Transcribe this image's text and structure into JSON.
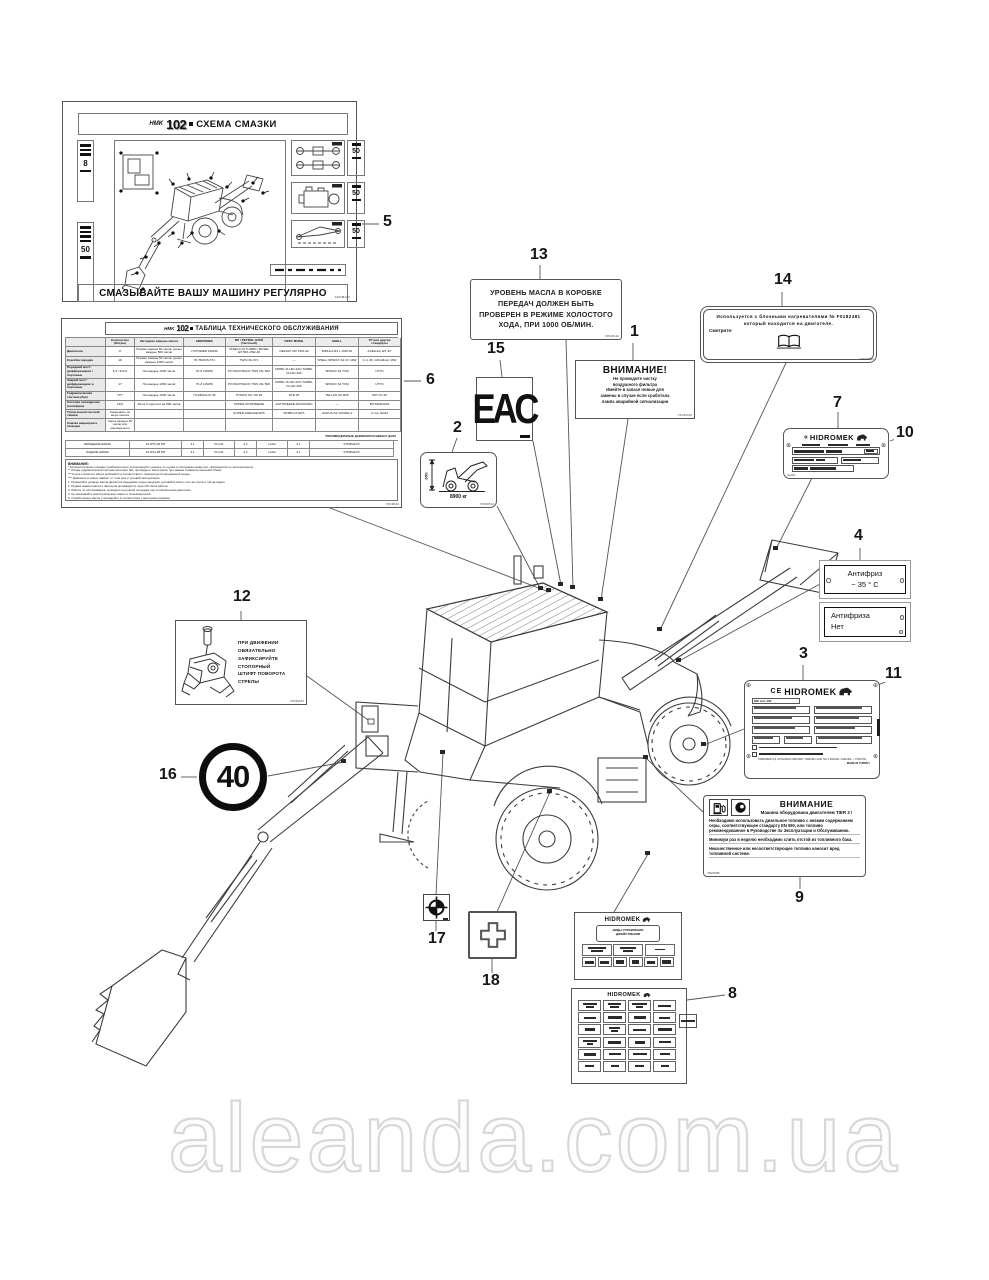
{
  "watermark": "aleanda.com.ua",
  "callouts": {
    "n1": "1",
    "n2": "2",
    "n3": "3",
    "n4": "4",
    "n5": "5",
    "n6": "6",
    "n7": "7",
    "n8": "8",
    "n9": "9",
    "n10": "10",
    "n11": "11",
    "n12": "12",
    "n13": "13",
    "n14": "14",
    "n15": "15",
    "n16": "16",
    "n17": "17",
    "n18": "18"
  },
  "lube": {
    "brand": "HMK",
    "model": "102",
    "title": "СХЕМА СМАЗКИ",
    "left_top": "8",
    "left_bottom": "50",
    "r1": "50",
    "r2": "50",
    "r3": "50",
    "bottom": "СМАЗЫВАЙТЕ ВАШУ МАШИНУ РЕГУЛЯРНО",
    "code": "A02/M102"
  },
  "maint": {
    "brand": "HMK",
    "model": "102",
    "title": "ТАБЛИЦА ТЕХНИЧЕСКОГО ОБСЛУЖИВАНИЯ",
    "grid": [
      [
        "",
        "Количество (Литры)",
        "Интервал замены масла",
        "HIDROMEK",
        "BP / PETROL OFİSİ (Частный)",
        "OPET MOBIL",
        "SHELL",
        "ТР или другие стандарты"
      ],
      [
        "Двигатель",
        "8",
        "Первая замена 50 часов, далее каждые 500 часов",
        "HI POWER 10W40",
        "VANELLUS TURBO / BCSEL EXTRA 15W-40",
        "DELVAC MX 15W-40",
        "RIMULA R4 L 15W-40",
        "ACEA E3, E5, E7"
      ],
      [
        "Коробка передач",
        "16",
        "Первая замена 50 часов, далее каждые 1000 часов",
        "HI-TRANS 671",
        "TWS OIL 671",
        "—",
        "SHELL SPIRAX S4 CX 10W",
        "C-4, ZF, GM Allison 10W"
      ],
      [
        "Передний мост: дифференциал / бортовые",
        "6,3 / 2x0,6",
        "На каждые 1000 часов",
        "HI-Z 10W30",
        "PO MAXTRACK TWS OIL 500",
        "MOBIL FLUID 424 / MOBIL FLUID 426",
        "SPIRAX S4 TXM",
        "UTTO"
      ],
      [
        "Задний мост: дифференциал и бортовые",
        "17",
        "На каждые 1000 часов",
        "HI-Z 10W30",
        "PO MAXTRACK TWS OIL 500",
        "MOBIL FLUID 424 / MOBIL FLUID 426",
        "SPIRAX S4 TXM",
        "UTTO"
      ],
      [
        "Гидравлическая система (бак)",
        "70**",
        "На каждые 1000 часов",
        "HI-DRAULIC 46",
        "HYDRO OIL XD 46",
        "DTE 25",
        "TELLUS S2 M46",
        "ISO VG 46"
      ],
      [
        "Система охлаждения (антифриз)",
        "18,5",
        "Раз в 2 года или на 500 часов",
        "",
        "SUPER ANTIFREEZE",
        "ANTIFREEZE ADVANCED",
        "—",
        "BS 6580/1992"
      ],
      [
        "Точки консистентной смазки",
        "Смазывать по мере износа",
        "",
        "",
        "SUPER GREASE EPS",
        "MOBILUX EPS",
        "GADUS S2 V220AD 2",
        "Li-Ca, MoS2"
      ],
      [
        "Смазка шарниров и пальцев",
        "Через каждые 50 часов или еженедельно",
        "",
        "",
        "",
        "",
        "",
        ""
      ]
    ],
    "tires_title": "РЕКОМЕНДУЕМЫЕ ДАВЛЕНИЯ В ШИНАХ (БАР)",
    "tires": [
      [
        "ПЕРЕДНИЕ ШИНЫ",
        "16.9/70-30 PR",
        "3.1",
        "PCL41",
        "4.4",
        "LASA",
        "3.1",
        "STARMAXX"
      ],
      [
        "ЗАДНИЕ ШИНЫ",
        "16.9/14-28 PR",
        "3.1",
        "PCL41",
        "4.4",
        "LASA",
        "3.1",
        "STARMAXX"
      ]
    ],
    "notes_title": "ВНИМАНИЕ:",
    "notes_starred": [
      "* Количество масел указано приблизительно; контролируйте уровень по щупам и смотровым окнам (см. «Руководство по эксплуатации»).",
      "** Объём гидравлической системы включает бак, цилиндры и магистрали; при замене сливается меньший объём.",
      "*** Сорта и вязкость масел выбирайте в соответствии с температурой окружающей среды.",
      "**** Давление в шинах зависит от типа шин и условий эксплуатации."
    ],
    "notes_numbered": [
      "1. Проверяйте уровень масла двигателя ежедневно перед запуском; доливайте масло того же сорта и той же марки.",
      "2. Первая замена масла и фильтров производится через 50 часов работы.",
      "3. Работы по обслуживанию проводите на ровной площадке при остановленном двигателе.",
      "4. Не смешивайте масла различных марок и производителей.",
      "5. Отработанные масла утилизируйте в соответствии с местными нормами.",
      "6. Консистентную смазку наносите до появления свежей смазки из зазоров."
    ],
    "code": "Y06/M102"
  },
  "gearbox": {
    "lines": [
      "УРОВЕНЬ МАСЛА В КОРОБКЕ",
      "ПЕРЕДАЧ ДОЛЖЕН БЫТЬ",
      "ПРОВЕРЕН В РЕЖИМЕ ХОЛОСТОГО",
      "ХОДА, ПРИ 1000 ОБ/МИН."
    ],
    "code": "Y05/30116"
  },
  "warn1": {
    "title": "ВНИМАНИЕ!",
    "lines": [
      "Не проводите чистку",
      "воздушного фильтра",
      "Имейте в запасе новые для",
      "замены в случае если сработала",
      "лампа аварийной сигнализации"
    ],
    "code": "Y05/30445"
  },
  "heater": {
    "line1": "Используется с блочными нагревателями № F0182481",
    "line2": "который находится на двигателе.",
    "see": "Смотрите:",
    "code": "Y05/30502"
  },
  "eac": {
    "text": "EAC"
  },
  "lift": {
    "dim": "385",
    "weight": "8900 кг",
    "code": "Y05/30513"
  },
  "plate7": {
    "brand_prefix": "«",
    "brand": "HIDROMEK",
    "code": "HL/001"
  },
  "anti": {
    "a1": "Антифриз",
    "a2": "− 35 ° C",
    "b1": "Антифриза",
    "b2": "Нет"
  },
  "plate3": {
    "ce": "CE",
    "brand": "HIDROMEK",
    "type_line": "HM тип: 102",
    "footer1": "HIDROMEK A.Ş. AHİ EVRAN OSB MAH. OSMANLI CAD. NO:1 SİNCAN / ANKARA — TÜRKİYE",
    "footer2": "MADE IN TURKEY"
  },
  "lock12": {
    "lines": [
      "ПРИ ДВИЖЕНИИ ОБЯЗАТЕЛЬНО",
      "ЗАФИКСИРУЙТЕ СТОПОРНЫЙ",
      "ШТИФТ ПОВОРОТА СТРЕЛЫ"
    ],
    "code": "Y05/30643"
  },
  "speed": {
    "value": "40"
  },
  "warn9": {
    "title": "ВНИМАНИЕ",
    "subtitle": "Машина оборудована двигателем TIER 3 !",
    "lines": [
      "Необходимо использовать дизельное топливо с низким содержанием серы, соответствующее стандарту EN 590, или топливо рекомендованное в Руководстве по Эксплуатации и Обслуживанию.",
      "Минимум раз в неделю необходимо слить отстой из топливного бака.",
      "Некачественное или несоответствующее топливо наносит вред топливной системе."
    ],
    "code": "Y05/30495"
  },
  "plate8": {
    "brand": "HIDROMEK",
    "box_line1": "ВИДЫ УПРАВЛЕНИЯ",
    "box_line2": "ДЖОЙСТИКАМИ"
  }
}
